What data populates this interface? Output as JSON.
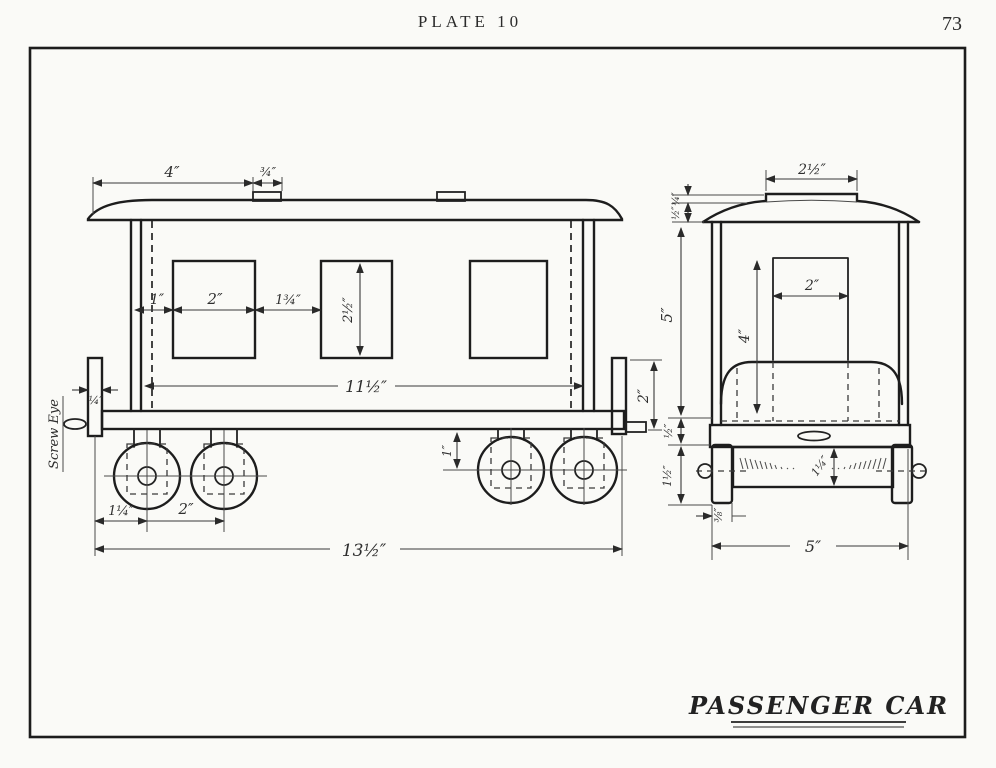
{
  "page": {
    "plate_label": "PLATE 10",
    "page_number": "73",
    "drawing_title": "PASSENGER CAR"
  },
  "side_view": {
    "screw_eye_label": "Screw Eye",
    "dims": {
      "roof_length": "4″",
      "roof_vent_width": "¾″",
      "end_post_width": "¼″",
      "window_offset": "1″",
      "window_width": "2″",
      "window_gap": "1¾″",
      "window_height": "2½″",
      "body_length": "11½″",
      "end_post_height": "2″",
      "truck_hanger_height": "1″",
      "wheel_offset": "1¼″",
      "wheel_spacing": "2″",
      "overall_length": "13½″"
    }
  },
  "end_view": {
    "dims": {
      "clerestory_width": "2½″",
      "clerestory_height": "¼″",
      "roof_height": "½″",
      "body_height": "5″",
      "floor_depth": "½″",
      "truck_height": "1½″",
      "door_width": "2″",
      "door_height": "4″",
      "axle_height": "1¼″",
      "wheel_thickness": "⅜″",
      "overall_width": "5″"
    }
  }
}
